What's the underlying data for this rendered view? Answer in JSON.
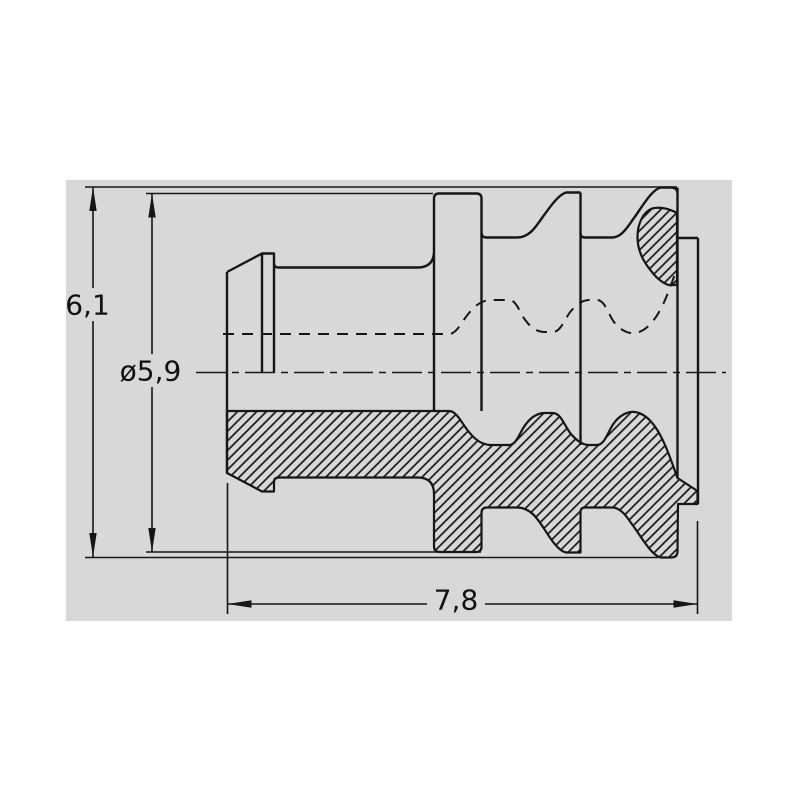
{
  "drawing": {
    "canvas_color": "#d8d8d8",
    "line_color": "#161616",
    "background_color": "#ffffff",
    "dimensions": {
      "overall_height": "6,1",
      "seal_diameter": "ø5,9",
      "overall_length": "7,8"
    }
  }
}
